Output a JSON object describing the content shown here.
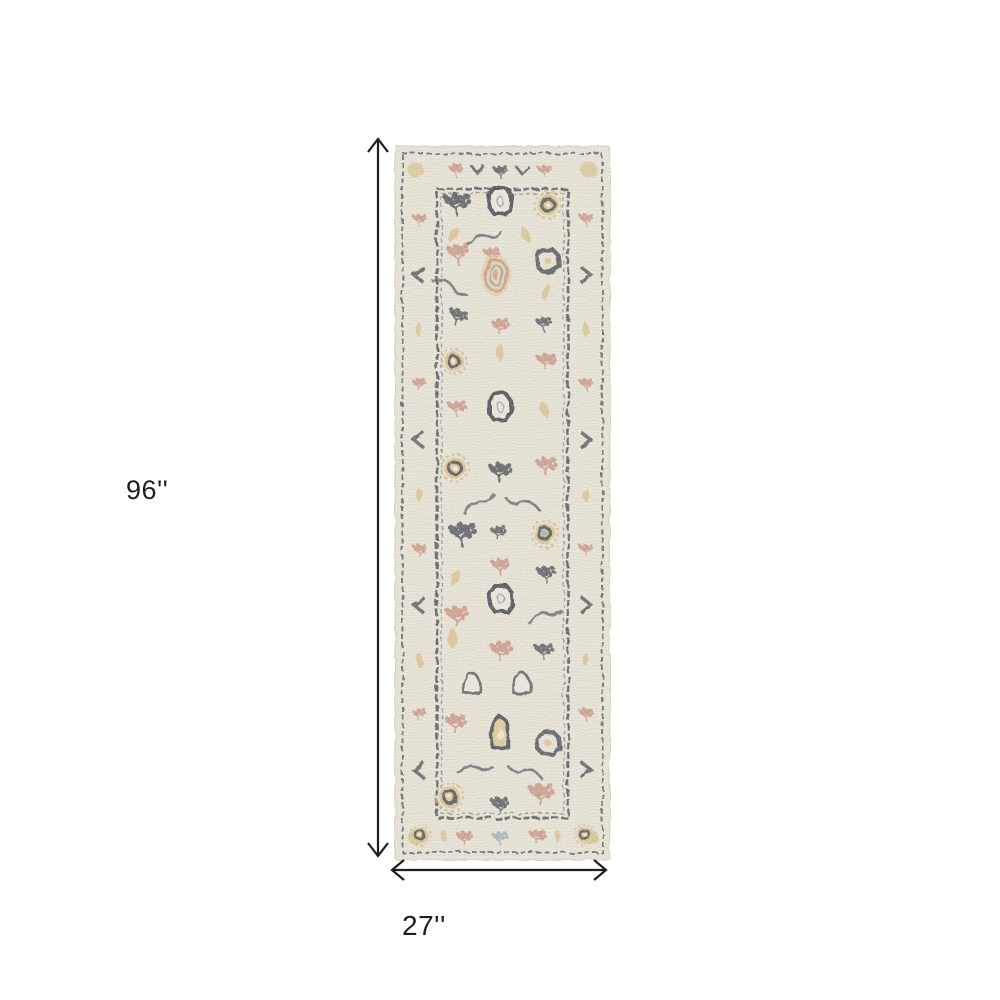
{
  "figure": {
    "type": "product-dimensions",
    "background": "#ffffff"
  },
  "annotation": {
    "height_label": "96''",
    "width_label": "27''"
  },
  "rug": {
    "description": "Distressed ivory oriental runner rug with charcoal, gold and dusty-rose floral medallion pattern"
  },
  "colors": {
    "background": "#ffffff",
    "ink": "#1e1e1e",
    "rug-ivory": "#e8e3d6",
    "rug-weave": "#dbd6c7",
    "rug-charcoal": "#3e434a",
    "rug-gold": "#d3b87e",
    "rug-rose": "#c48d7c",
    "rug-bluegray": "#8fa3ad"
  }
}
